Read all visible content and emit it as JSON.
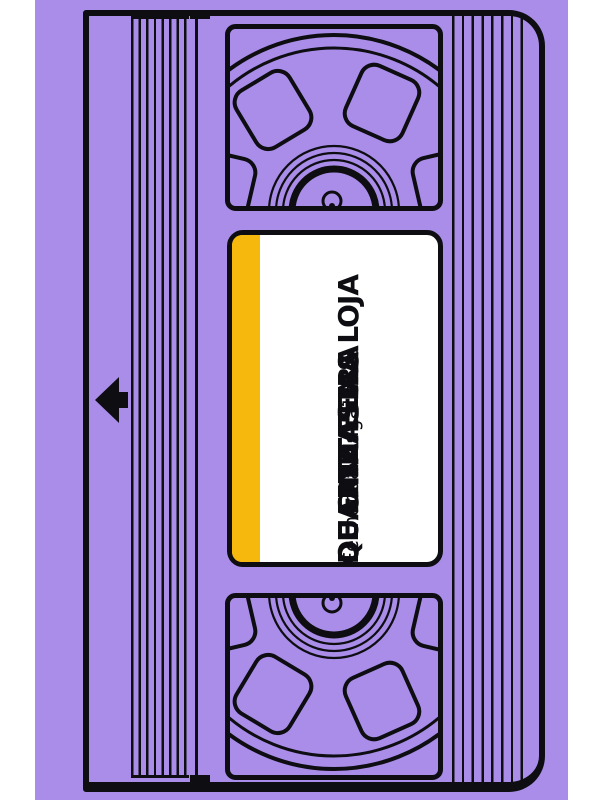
{
  "page": {
    "type": "book-cover-illustration",
    "subject": "vhs-tape"
  },
  "cover": {
    "title_lines": [
      "QUARTA-FEIRA",
      "DE CINZAS NA LOJA",
      "DE FANTASIAS"
    ],
    "author": "Fernanda Magalhães",
    "colors": {
      "background": "#a98de9",
      "page_margin": "#ffffff",
      "line": "#0d0d12",
      "label_background": "#ffffff",
      "label_stripe": "#f6b80c",
      "text": "#0d0d12"
    },
    "icons": {
      "arrow": "left-arrow-icon",
      "reel_top": "tape-reel-icon",
      "reel_bottom": "tape-reel-icon"
    }
  }
}
